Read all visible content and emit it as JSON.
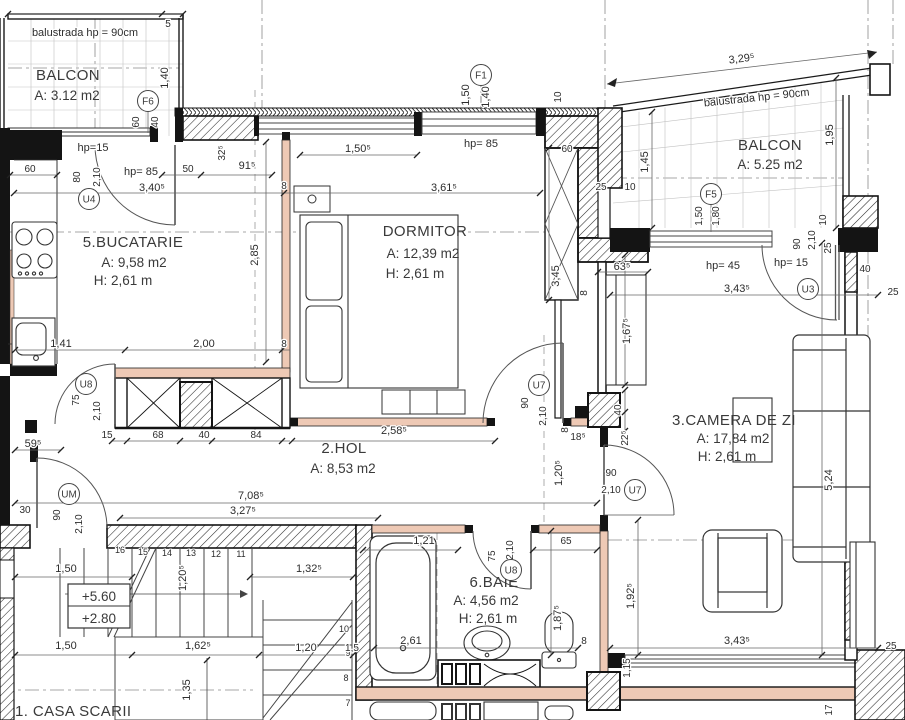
{
  "rooms": {
    "balcon_tl": {
      "name": "BALCON",
      "area": "A: 3.12 m2"
    },
    "bucatarie": {
      "name": "5.BUCATARIE",
      "area": "A: 9,58 m2",
      "height": "H: 2,61 m"
    },
    "dormitor": {
      "name": "DORMITOR",
      "area": "A: 12,39 m2",
      "height": "H: 2,61 m"
    },
    "balcon_tr": {
      "name": "BALCON",
      "area": "A: 5.25 m2"
    },
    "camera_de_zi": {
      "name": "3.CAMERA DE ZI",
      "area": "A: 17,84 m2",
      "height": "H: 2,61 m"
    },
    "hol": {
      "name": "2.HOL",
      "area": "A: 8,53 m2"
    },
    "baie": {
      "name": "6.BAIE",
      "area": "A: 4,56 m2",
      "height": "H: 2,61 m"
    },
    "casa_scarii": {
      "name": "1. CASA SCARII"
    }
  },
  "openings": {
    "f6": "F6",
    "u4": "U4",
    "f1": "F1",
    "f5": "F5",
    "u3": "U3",
    "u7": "U7",
    "u8": "U8",
    "um": "UM"
  },
  "annotations": {
    "balustrada": "balustrada hp = 90cm",
    "hp15": "hp=15",
    "hp85": "hp= 85",
    "hp45": "hp= 45",
    "hp15b": "hp= 15",
    "level_up": "+5.60",
    "level_dn": "+2.80"
  },
  "dims": {
    "n5": "5",
    "n8": "8",
    "n10": "10",
    "n15": "15",
    "n17": "17",
    "n25": "25",
    "n30": "30",
    "n40": "40",
    "n50": "50",
    "n60": "60",
    "n65": "65",
    "n68": "68",
    "n75": "75",
    "n80": "80",
    "n84": "84",
    "n90": "90",
    "d115": "1,15",
    "d120": "1,20",
    "d1205": "1,20⁵",
    "d121": "1,21",
    "d1325": "1,32⁵",
    "d135": "1,35",
    "d140": "1,40",
    "d141": "1,41",
    "d145": "1,45",
    "d15": "1,5",
    "d150": "1,50",
    "d1505": "1,50⁵",
    "d1625": "1,62⁵",
    "d1675": "1,67⁵",
    "d180": "1,80",
    "d185": "18⁵",
    "d1875": "1,87⁵",
    "d1925": "1,92⁵",
    "d195": "1,95",
    "d200": "2,00",
    "d210": "2,10",
    "d225": "22⁵",
    "d2585": "2,58⁵",
    "d261": "2,61",
    "d285": "2,85",
    "d325": "32⁵",
    "d3275": "3,27⁵",
    "d3295": "3,29⁵",
    "d340": "3,40⁵",
    "d343": "3,43⁵",
    "d345": "3,45",
    "d3615": "3,61⁵",
    "d524": "5,24",
    "d595": "59⁵",
    "d635": "63⁵",
    "d7085": "7,08⁵",
    "d915": "91⁵"
  },
  "stairs": {
    "upper": [
      "16",
      "15",
      "14",
      "13",
      "12",
      "11"
    ],
    "lower": [
      "10",
      "9",
      "8",
      "7"
    ]
  }
}
